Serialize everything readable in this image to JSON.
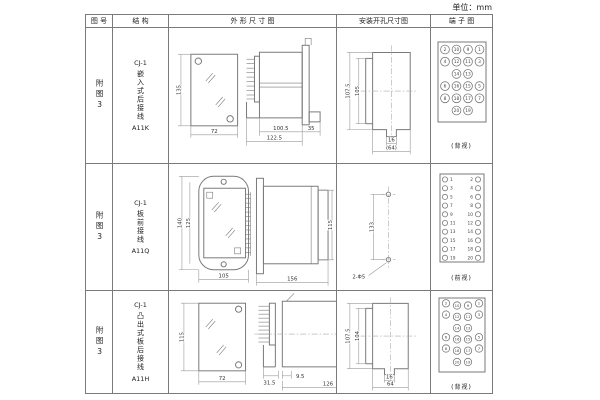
{
  "unit_label": "单位：mm",
  "colors": {
    "line": "#7a7a7a",
    "dim_line": "#9a9a9a",
    "text": "#222222",
    "background": "#ffffff"
  },
  "table": {
    "headers": {
      "fig_no": "图 号",
      "structure": "结 构",
      "outline": "外 形 尺 寸 图",
      "mounting": "安装开孔尺寸图",
      "terminal": "端 子 图"
    }
  },
  "rows": [
    {
      "fig_no": "附图3",
      "structure": {
        "model": "CJ-1",
        "desc": "嵌入式后接线",
        "code": "A11K"
      },
      "outline": {
        "height": "135",
        "width": "72",
        "body_len": "100.5",
        "total_len": "122.5",
        "rear_len": "35"
      },
      "mounting": {
        "outer_h": "107.5",
        "inner_h": "105",
        "slot_w": "16",
        "span_w": "(64)"
      },
      "terminal": {
        "view_label": "(背视)",
        "grid": [
          [
            "2",
            "10",
            "9",
            "1"
          ],
          [
            "4",
            "12",
            "11",
            "3"
          ],
          [
            "",
            "14",
            "13",
            ""
          ],
          [
            "6",
            "16",
            "15",
            "5"
          ],
          [
            "8",
            "18",
            "17",
            "7"
          ],
          [
            "",
            "20",
            "19",
            ""
          ]
        ]
      }
    },
    {
      "fig_no": "附图3",
      "structure": {
        "model": "CJ-1",
        "desc": "板前接线",
        "code": "A11Q"
      },
      "outline": {
        "outer_h": "140",
        "inner_h": "125",
        "width": "105",
        "body_len": "156",
        "side_h": "115"
      },
      "mounting": {
        "hole_span": "133",
        "hole_spec": "2-Φ5"
      },
      "terminal": {
        "view_label": "(前视)",
        "pairs": [
          [
            "1",
            "2"
          ],
          [
            "3",
            "4"
          ],
          [
            "5",
            "6"
          ],
          [
            "7",
            "8"
          ],
          [
            "9",
            "10"
          ],
          [
            "11",
            "12"
          ],
          [
            "13",
            "14"
          ],
          [
            "15",
            "16"
          ],
          [
            "17",
            "18"
          ],
          [
            "19",
            "20"
          ]
        ]
      }
    },
    {
      "fig_no": "附图3",
      "structure": {
        "model": "CJ-1",
        "desc": "凸出式板后接线",
        "code": "A11H"
      },
      "outline": {
        "height": "115",
        "width": "72",
        "foot_len": "31.5",
        "offset": "9.5",
        "body_len": "126"
      },
      "mounting": {
        "outer_h": "107.5",
        "inner_h": "104",
        "slot_w": "16",
        "span_w": "64"
      },
      "terminal": {
        "view_label": "(背视)",
        "grid": [
          [
            "2",
            "10",
            "9",
            "1"
          ],
          [
            "4",
            "12",
            "11",
            "3"
          ],
          [
            "",
            "14",
            "13",
            ""
          ],
          [
            "6",
            "16",
            "15",
            "5"
          ],
          [
            "8",
            "18",
            "17",
            "7"
          ],
          [
            "",
            "20",
            "19",
            ""
          ]
        ]
      }
    }
  ]
}
